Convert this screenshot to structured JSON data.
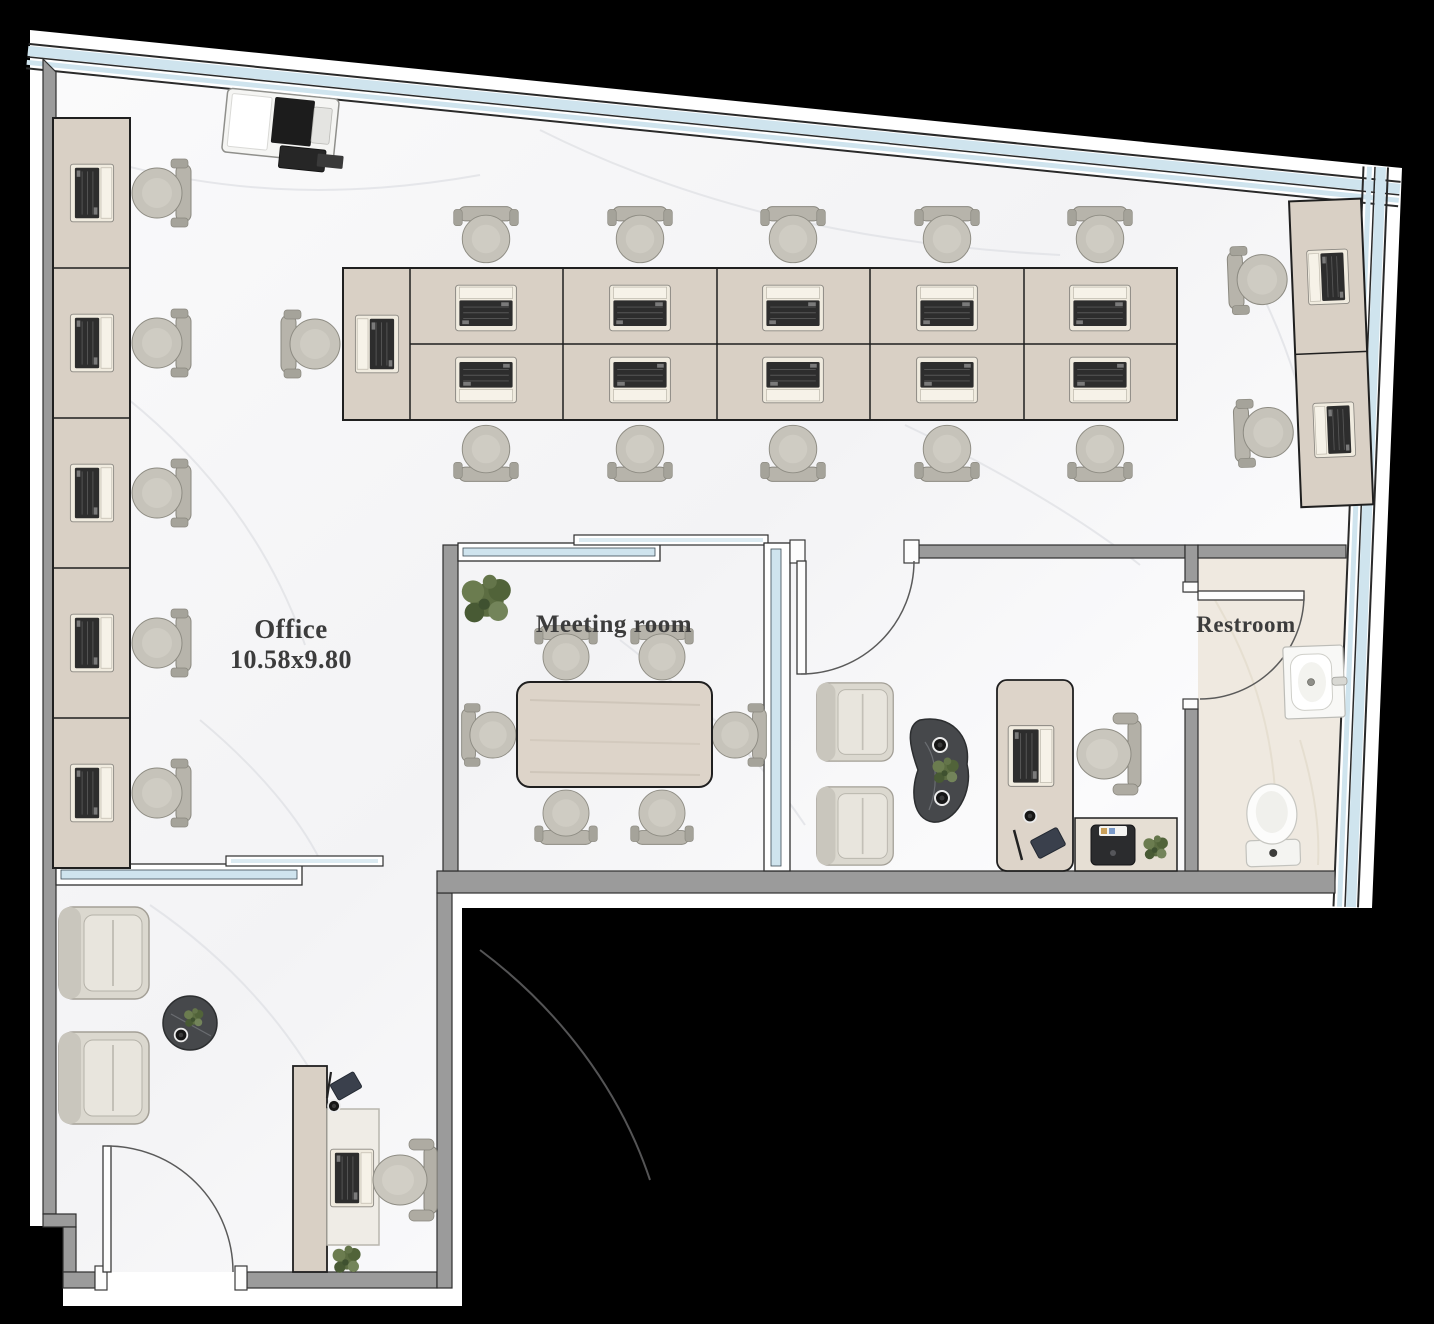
{
  "rooms": [
    {
      "id": "office",
      "label": "Office",
      "dimensions": "10.58x9.80"
    },
    {
      "id": "meeting_room",
      "label": "Meeting room"
    },
    {
      "id": "restroom",
      "label": "Restroom"
    }
  ],
  "palette": {
    "background": "#000000",
    "outer_wall_band": "#ffffff",
    "interior_wall_gray": "#9b9b9b",
    "window_glass_blue": "#cfe4ee",
    "floor_marble": "#f7f7f8",
    "restroom_floor": "#efe9e0",
    "wood_furniture": "#d9d0c5",
    "chair_gray": "#c6c3ba",
    "laptop_keyboard_dark": "#2d2d2d",
    "coffee_table_dark": "#46484b",
    "plant_green": "#5c6d42",
    "label_text": "#3c3c3c"
  },
  "furniture_icons": {
    "workstation_desk": "wood rectangle",
    "task_chair": "round seat with back bar",
    "laptop": "light base with dark keyboard",
    "armchair": "square lounge chair",
    "executive_chair": "seat with curved back",
    "meeting_table": "rounded wood rectangle",
    "coffee_table": "dark stone blob",
    "plant": "green leaf cluster",
    "copier": "white body with dark tray",
    "printer": "dark box with paper",
    "toilet": "oval bowl with tank",
    "sink": "white counter with basin",
    "door": "leaf with quarter-circle swing arc",
    "window_band": "double blue glazing line"
  }
}
